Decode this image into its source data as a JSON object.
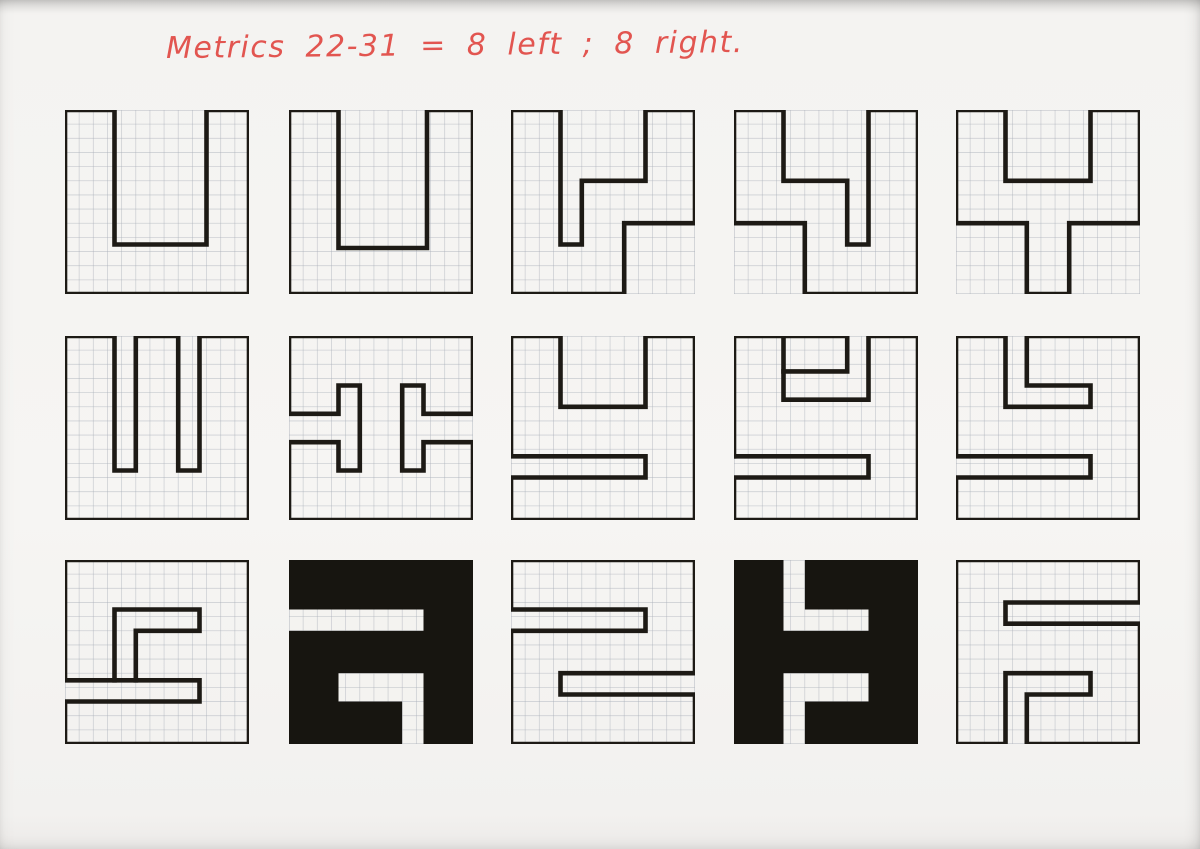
{
  "page": {
    "note_text": "Metrics 22-31 = 8 left ; 8 right.",
    "note_color": "#e25550",
    "ink_color": "#1d1a15",
    "fill_color": "#171510",
    "paper_color": "#f4f3f0",
    "grid_color": "#a8aeb8",
    "grid_border_color": "#8b919c"
  },
  "grid": {
    "cols": 13,
    "rows": 13
  },
  "tiles": [
    {
      "name": "r1c1",
      "row": 1,
      "col": 1,
      "desc": "u-wide-notch",
      "style": "outline",
      "strokes": [
        {
          "closed": true,
          "points": [
            [
              0,
              0
            ],
            [
              3.5,
              0
            ],
            [
              3.5,
              9.5
            ],
            [
              10,
              9.5
            ],
            [
              10,
              0
            ],
            [
              13,
              0
            ],
            [
              13,
              13
            ],
            [
              0,
              13
            ]
          ]
        }
      ]
    },
    {
      "name": "r1c2",
      "row": 1,
      "col": 2,
      "desc": "u-notch",
      "style": "outline",
      "strokes": [
        {
          "closed": true,
          "points": [
            [
              0,
              0
            ],
            [
              3.5,
              0
            ],
            [
              3.5,
              9.75
            ],
            [
              9.75,
              9.75
            ],
            [
              9.75,
              0
            ],
            [
              13,
              0
            ],
            [
              13,
              13
            ],
            [
              0,
              13
            ]
          ]
        }
      ]
    },
    {
      "name": "r1c3",
      "row": 1,
      "col": 3,
      "desc": "stepped-y-left",
      "style": "outline",
      "strokes": [
        {
          "closed": true,
          "points": [
            [
              0,
              0
            ],
            [
              3.5,
              0
            ],
            [
              3.5,
              9.5
            ],
            [
              5,
              9.5
            ],
            [
              5,
              5
            ],
            [
              9.5,
              5
            ],
            [
              9.5,
              0
            ],
            [
              13,
              0
            ],
            [
              13,
              8
            ],
            [
              8,
              8
            ],
            [
              8,
              13
            ],
            [
              0,
              13
            ]
          ]
        }
      ]
    },
    {
      "name": "r1c4",
      "row": 1,
      "col": 4,
      "desc": "stepped-y-right",
      "style": "outline",
      "strokes": [
        {
          "closed": true,
          "points": [
            [
              0,
              0
            ],
            [
              3.5,
              0
            ],
            [
              3.5,
              5
            ],
            [
              8,
              5
            ],
            [
              8,
              9.5
            ],
            [
              9.5,
              9.5
            ],
            [
              9.5,
              0
            ],
            [
              13,
              0
            ],
            [
              13,
              13
            ],
            [
              5,
              13
            ],
            [
              5,
              8
            ],
            [
              0,
              8
            ]
          ]
        }
      ]
    },
    {
      "name": "r1c5",
      "row": 1,
      "col": 5,
      "desc": "y-center-stem",
      "style": "outline",
      "strokes": [
        {
          "closed": true,
          "points": [
            [
              0,
              0
            ],
            [
              3.5,
              0
            ],
            [
              3.5,
              5
            ],
            [
              9.5,
              5
            ],
            [
              9.5,
              0
            ],
            [
              13,
              0
            ],
            [
              13,
              8
            ],
            [
              8,
              8
            ],
            [
              8,
              13
            ],
            [
              5,
              13
            ],
            [
              5,
              8
            ],
            [
              0,
              8
            ]
          ]
        }
      ]
    },
    {
      "name": "r2c1",
      "row": 2,
      "col": 1,
      "desc": "sha-double-notch",
      "style": "outline",
      "strokes": [
        {
          "closed": true,
          "points": [
            [
              0,
              0
            ],
            [
              3.5,
              0
            ],
            [
              3.5,
              9.5
            ],
            [
              5,
              9.5
            ],
            [
              5,
              0
            ],
            [
              8,
              0
            ],
            [
              8,
              9.5
            ],
            [
              9.5,
              9.5
            ],
            [
              9.5,
              0
            ],
            [
              13,
              0
            ],
            [
              13,
              13
            ],
            [
              0,
              13
            ]
          ]
        }
      ]
    },
    {
      "name": "r2c2",
      "row": 2,
      "col": 2,
      "desc": "double-t-side-slots",
      "style": "outline",
      "strokes": [
        {
          "closed": true,
          "points": [
            [
              0,
              0
            ],
            [
              13,
              0
            ],
            [
              13,
              5.5
            ],
            [
              9.5,
              5.5
            ],
            [
              9.5,
              3.5
            ],
            [
              8,
              3.5
            ],
            [
              8,
              9.5
            ],
            [
              9.5,
              9.5
            ],
            [
              9.5,
              7.5
            ],
            [
              13,
              7.5
            ],
            [
              13,
              13
            ],
            [
              0,
              13
            ],
            [
              0,
              7.5
            ],
            [
              3.5,
              7.5
            ],
            [
              3.5,
              9.5
            ],
            [
              5,
              9.5
            ],
            [
              5,
              3.5
            ],
            [
              3.5,
              3.5
            ],
            [
              3.5,
              5.5
            ],
            [
              0,
              5.5
            ]
          ]
        }
      ]
    },
    {
      "name": "r2c3",
      "row": 2,
      "col": 3,
      "desc": "u-with-left-slot",
      "style": "outline",
      "strokes": [
        {
          "closed": true,
          "points": [
            [
              0,
              0
            ],
            [
              3.5,
              0
            ],
            [
              3.5,
              5
            ],
            [
              9.5,
              5
            ],
            [
              9.5,
              0
            ],
            [
              13,
              0
            ],
            [
              13,
              13
            ],
            [
              0,
              13
            ],
            [
              0,
              10
            ],
            [
              9.5,
              10
            ],
            [
              9.5,
              8.5
            ],
            [
              0,
              8.5
            ]
          ]
        }
      ]
    },
    {
      "name": "r2c4",
      "row": 2,
      "col": 4,
      "desc": "u-left-slot-top-pocket",
      "style": "outline",
      "strokes": [
        {
          "closed": false,
          "points": [
            [
              0,
              8.5
            ],
            [
              0,
              0
            ],
            [
              8,
              0
            ],
            [
              8,
              2.5
            ],
            [
              3.5,
              2.5
            ]
          ]
        },
        {
          "closed": false,
          "points": [
            [
              3.5,
              0
            ],
            [
              3.5,
              4.5
            ],
            [
              9.5,
              4.5
            ],
            [
              9.5,
              0
            ],
            [
              13,
              0
            ],
            [
              13,
              13
            ],
            [
              0,
              13
            ],
            [
              0,
              10
            ],
            [
              9.5,
              10
            ],
            [
              9.5,
              8.5
            ],
            [
              0,
              8.5
            ]
          ]
        }
      ]
    },
    {
      "name": "r2c5",
      "row": 2,
      "col": 5,
      "desc": "e-hook-left-slot",
      "style": "outline",
      "strokes": [
        {
          "closed": true,
          "points": [
            [
              0,
              0
            ],
            [
              3.5,
              0
            ],
            [
              3.5,
              5
            ],
            [
              9.5,
              5
            ],
            [
              9.5,
              3.5
            ],
            [
              5,
              3.5
            ],
            [
              5,
              0
            ],
            [
              13,
              0
            ],
            [
              13,
              13
            ],
            [
              0,
              13
            ],
            [
              0,
              10
            ],
            [
              9.5,
              10
            ],
            [
              9.5,
              8.5
            ],
            [
              0,
              8.5
            ]
          ]
        }
      ]
    },
    {
      "name": "r3c1",
      "row": 3,
      "col": 1,
      "desc": "spiral-s-slot",
      "style": "outline",
      "strokes": [
        {
          "closed": true,
          "points": [
            [
              0,
              0
            ],
            [
              13,
              0
            ],
            [
              13,
              13
            ],
            [
              0,
              13
            ],
            [
              0,
              10
            ],
            [
              9.5,
              10
            ],
            [
              9.5,
              8.5
            ],
            [
              0,
              8.5
            ]
          ]
        },
        {
          "closed": false,
          "points": [
            [
              3.5,
              8.5
            ],
            [
              3.5,
              3.5
            ],
            [
              9.5,
              3.5
            ],
            [
              9.5,
              5
            ],
            [
              5,
              5
            ],
            [
              5,
              8.5
            ]
          ]
        }
      ]
    },
    {
      "name": "r3c2",
      "row": 3,
      "col": 2,
      "desc": "inverted-spiral-s",
      "style": "filled",
      "slots": [
        [
          [
            0,
            3.5
          ],
          [
            9.5,
            3.5
          ],
          [
            9.5,
            5
          ],
          [
            0,
            5
          ]
        ],
        [
          [
            3.5,
            8
          ],
          [
            9.5,
            8
          ],
          [
            9.5,
            13
          ],
          [
            8,
            13
          ],
          [
            8,
            10
          ],
          [
            3.5,
            10
          ]
        ]
      ]
    },
    {
      "name": "r3c3",
      "row": 3,
      "col": 3,
      "desc": "z-double-side-slots",
      "style": "outline",
      "strokes": [
        {
          "closed": true,
          "points": [
            [
              0,
              0
            ],
            [
              13,
              0
            ],
            [
              13,
              8
            ],
            [
              3.5,
              8
            ],
            [
              3.5,
              9.5
            ],
            [
              13,
              9.5
            ],
            [
              13,
              13
            ],
            [
              0,
              13
            ],
            [
              0,
              5
            ],
            [
              9.5,
              5
            ],
            [
              9.5,
              3.5
            ],
            [
              0,
              3.5
            ]
          ]
        }
      ]
    },
    {
      "name": "r3c4",
      "row": 3,
      "col": 4,
      "desc": "inverted-h-form",
      "style": "filled",
      "slots": [
        [
          [
            3.5,
            0
          ],
          [
            5,
            0
          ],
          [
            5,
            3.5
          ],
          [
            9.5,
            3.5
          ],
          [
            9.5,
            5
          ],
          [
            3.5,
            5
          ]
        ],
        [
          [
            3.5,
            8
          ],
          [
            9.5,
            8
          ],
          [
            9.5,
            10
          ],
          [
            5,
            10
          ],
          [
            5,
            13
          ],
          [
            3.5,
            13
          ]
        ]
      ]
    },
    {
      "name": "r3c5",
      "row": 3,
      "col": 5,
      "desc": "r-hook-slots",
      "style": "outline",
      "strokes": [
        {
          "closed": true,
          "points": [
            [
              0,
              0
            ],
            [
              13,
              0
            ],
            [
              13,
              3
            ],
            [
              3.5,
              3
            ],
            [
              3.5,
              4.5
            ],
            [
              13,
              4.5
            ],
            [
              13,
              13
            ],
            [
              5,
              13
            ],
            [
              5,
              9.5
            ],
            [
              9.5,
              9.5
            ],
            [
              9.5,
              8
            ],
            [
              3.5,
              8
            ],
            [
              3.5,
              13
            ],
            [
              0,
              13
            ]
          ]
        }
      ]
    }
  ]
}
